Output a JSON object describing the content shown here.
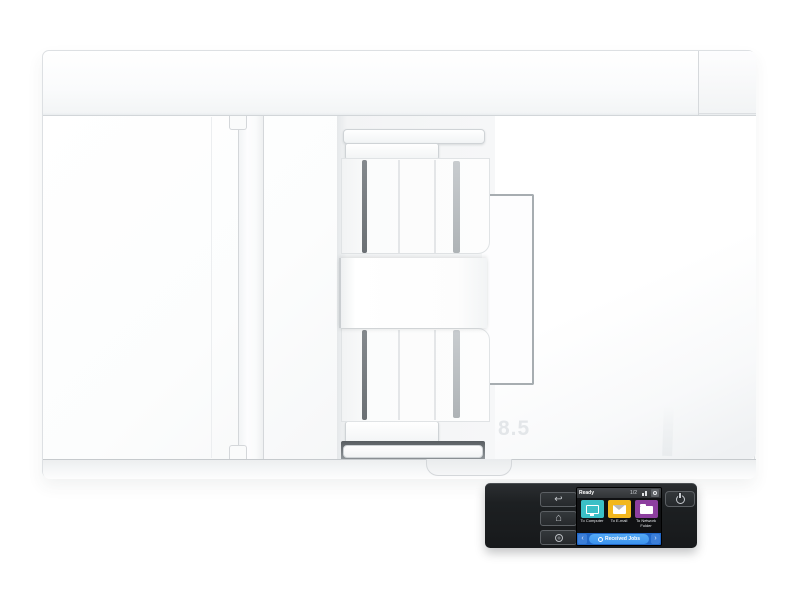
{
  "device": {
    "markings": {
      "paper_size": "8.5"
    }
  },
  "control_panel": {
    "hardware_buttons": {
      "back": {
        "icon": "back-arrow-icon",
        "glyph": "↩"
      },
      "home": {
        "icon": "home-icon",
        "glyph": "⌂"
      },
      "ring": {
        "icon": "help-ring-icon"
      },
      "power": {
        "icon": "power-icon"
      }
    },
    "screen": {
      "status_bar": {
        "status_text": "Ready",
        "page_indicator": "1/2",
        "icons": [
          "network-signal-icon",
          "settings-gear-icon"
        ]
      },
      "tiles": [
        {
          "label": "To Computer",
          "color": "#3bbfc6",
          "icon": "computer-monitor-icon"
        },
        {
          "label": "To E-mail",
          "color": "#f2b71d",
          "icon": "envelope-icon"
        },
        {
          "label": "To Network Folder",
          "color": "#8d3f9f",
          "icon": "network-folder-icon"
        }
      ],
      "bottom_bar": {
        "label": "Received Jobs",
        "left_arrow": "‹",
        "right_arrow": "›",
        "icon": "jobs-badge-icon"
      }
    }
  },
  "colors": {
    "body_white": "#ffffff",
    "panel_dark": "#1d2022",
    "tile_teal": "#3bbfc6",
    "tile_yellow": "#f2b71d",
    "tile_purple": "#8d3f9f",
    "bottom_bar_blue": "#2268c8",
    "bottom_pill_blue": "#3c93ee"
  }
}
